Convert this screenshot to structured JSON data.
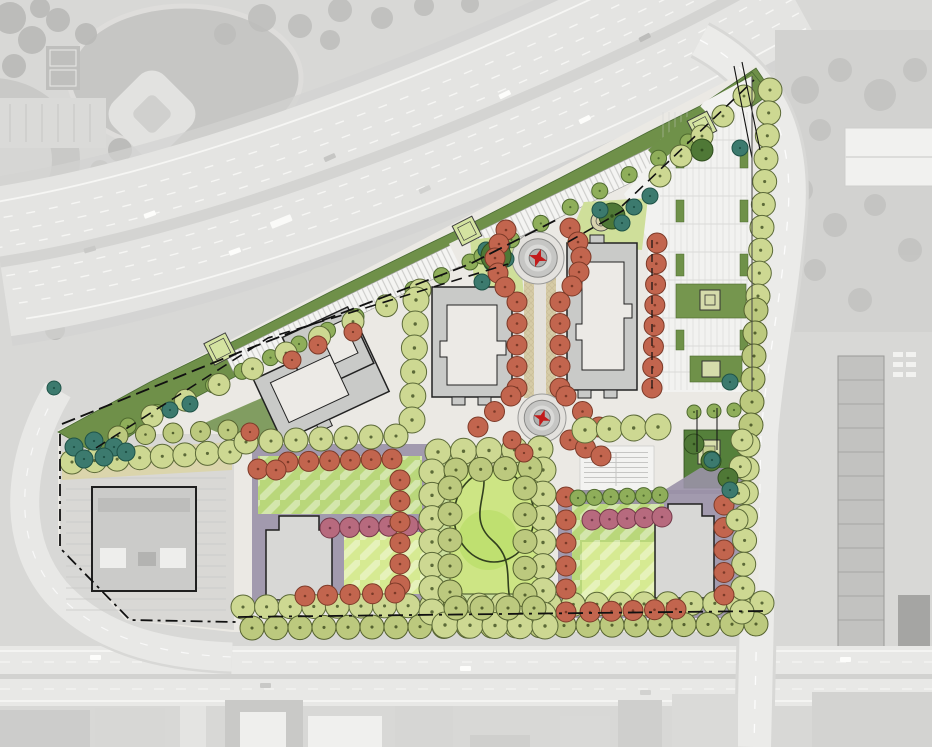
{
  "meta": {
    "view": "aerial-site-plan-rendering",
    "site": "triangular mixed-use development parcel between a freeway and a boulevard"
  },
  "palette": {
    "aerial_base": "#d8d8d6",
    "aerial_field": "#c6c6c4",
    "aerial_road": "#e9e9e7",
    "highway": "#e4e4e2",
    "verge": "#d0d0ce",
    "site_ground": "#ebe9e4",
    "buffer_green": "#6f9049",
    "canopy_dark": "#4f7836",
    "plaza_green": "#d4e3a1",
    "parking_white": "#f2f2f0",
    "stall_line": "#cfcfcd",
    "island_green": "#6f9149",
    "lawn": "#b9d77a",
    "lawn_bright": "#d6ea92",
    "park_lawn": "#cde584",
    "podium_purple": "#9a91a7",
    "building_fill": "#c9cac8",
    "building_stroke": "#222222",
    "footprint_white": "#eceae6",
    "tower_fill": "#d8d8d6",
    "paving_tan": "#d6cba6",
    "boundary": "#111111",
    "star_red": "#c21a1a",
    "roundabout_outer": "#e3e1dd"
  },
  "tree_types": {
    "olive": {
      "fill": "#cdd892",
      "stroke": "#5c6a38"
    },
    "olive2": {
      "fill": "#bcc97e",
      "stroke": "#55622f"
    },
    "green": {
      "fill": "#8fae5a",
      "stroke": "#4e6a2e"
    },
    "dark": {
      "fill": "#4f7836",
      "stroke": "#2f4d1d"
    },
    "teal": {
      "fill": "#3c7a6e",
      "stroke": "#1f5348"
    },
    "red": {
      "fill": "#c2654e",
      "stroke": "#7c3a28"
    },
    "pink": {
      "fill": "#b76a7e",
      "stroke": "#74394a"
    }
  },
  "trees": {
    "rows": [
      [
        "olive",
        243,
        607,
        762,
        603,
        23,
        12
      ],
      [
        "olive2",
        252,
        628,
        756,
        624,
        22,
        12
      ],
      [
        "olive",
        770,
        90,
        758,
        296,
        10,
        12
      ],
      [
        "olive2",
        756,
        310,
        751,
        425,
        6,
        12
      ],
      [
        "olive",
        748,
        445,
        742,
        612,
        8,
        12
      ],
      [
        "green",
        128,
        426,
        470,
        262,
        13,
        8
      ],
      [
        "green",
        482,
        256,
        688,
        142,
        8,
        8
      ],
      [
        "olive",
        152,
        416,
        420,
        290,
        9,
        11
      ],
      [
        "olive",
        72,
        462,
        230,
        452,
        8,
        12
      ],
      [
        "olive2",
        118,
        436,
        228,
        430,
        5,
        10
      ],
      [
        "olive",
        416,
        300,
        412,
        420,
        6,
        13
      ],
      [
        "olive",
        246,
        442,
        396,
        436,
        7,
        12
      ],
      [
        "red",
        517,
        302,
        517,
        388,
        5,
        10
      ],
      [
        "red",
        560,
        302,
        560,
        388,
        5,
        10
      ],
      [
        "red",
        511,
        396,
        478,
        427,
        3,
        10
      ],
      [
        "red",
        566,
        396,
        599,
        427,
        3,
        10
      ],
      [
        "red",
        570,
        440,
        601,
        456,
        3,
        10
      ],
      [
        "red",
        288,
        462,
        392,
        459,
        6,
        10
      ],
      [
        "red",
        258,
        469,
        276,
        470,
        2,
        10
      ],
      [
        "pink",
        330,
        528,
        428,
        525,
        6,
        10
      ],
      [
        "red",
        400,
        480,
        400,
        585,
        6,
        10
      ],
      [
        "red",
        305,
        596,
        395,
        593,
        5,
        10
      ],
      [
        "red",
        566,
        497,
        566,
        612,
        6,
        10
      ],
      [
        "pink",
        592,
        520,
        662,
        517,
        5,
        10
      ],
      [
        "red",
        590,
        612,
        676,
        609,
        5,
        10
      ],
      [
        "red",
        724,
        505,
        724,
        595,
        5,
        10
      ],
      [
        "red",
        657,
        243,
        652,
        388,
        8,
        10
      ],
      [
        "olive",
        438,
        452,
        540,
        449,
        5,
        13
      ],
      [
        "olive",
        543,
        470,
        543,
        615,
        7,
        13
      ],
      [
        "olive",
        432,
        472,
        432,
        612,
        7,
        13
      ],
      [
        "olive",
        445,
        625,
        545,
        626,
        5,
        13
      ],
      [
        "olive2",
        456,
        470,
        530,
        468,
        4,
        12
      ],
      [
        "olive2",
        525,
        488,
        525,
        595,
        5,
        12
      ],
      [
        "olive2",
        450,
        488,
        450,
        592,
        5,
        12
      ],
      [
        "olive2",
        456,
        608,
        534,
        608,
        4,
        12
      ],
      [
        "olive",
        585,
        430,
        658,
        427,
        4,
        13
      ],
      [
        "green",
        578,
        498,
        660,
        495,
        6,
        8
      ],
      [
        "olive",
        742,
        440,
        737,
        520,
        4,
        11
      ],
      [
        "olive",
        660,
        176,
        744,
        96,
        5,
        11
      ],
      [
        "dark",
        694,
        444,
        728,
        478,
        3,
        10
      ],
      [
        "green",
        694,
        412,
        734,
        410,
        3,
        7
      ]
    ],
    "singles": [
      [
        "teal",
        74,
        447,
        9
      ],
      [
        "teal",
        94,
        441,
        9
      ],
      [
        "teal",
        114,
        447,
        9
      ],
      [
        "teal",
        84,
        459,
        9
      ],
      [
        "teal",
        104,
        457,
        9
      ],
      [
        "teal",
        126,
        452,
        9
      ],
      [
        "teal",
        54,
        388,
        7
      ],
      [
        "teal",
        170,
        410,
        8
      ],
      [
        "teal",
        190,
        404,
        8
      ],
      [
        "teal",
        486,
        250,
        8
      ],
      [
        "teal",
        502,
        246,
        8
      ],
      [
        "teal",
        492,
        263,
        8
      ],
      [
        "teal",
        506,
        259,
        8
      ],
      [
        "dark",
        496,
        256,
        15
      ],
      [
        "teal",
        482,
        282,
        8
      ],
      [
        "dark",
        612,
        216,
        13
      ],
      [
        "teal",
        600,
        210,
        8
      ],
      [
        "teal",
        622,
        223,
        8
      ],
      [
        "teal",
        634,
        207,
        8
      ],
      [
        "teal",
        650,
        196,
        8
      ],
      [
        "teal",
        740,
        148,
        8
      ],
      [
        "dark",
        702,
        150,
        11
      ],
      [
        "teal",
        712,
        460,
        8
      ],
      [
        "teal",
        730,
        490,
        8
      ],
      [
        "teal",
        730,
        382,
        8
      ],
      [
        "red",
        250,
        432,
        9
      ],
      [
        "red",
        512,
        440,
        9
      ],
      [
        "red",
        524,
        453,
        9
      ],
      [
        "red",
        292,
        360,
        9
      ],
      [
        "red",
        318,
        345,
        9
      ],
      [
        "red",
        353,
        332,
        9
      ],
      [
        "red",
        506,
        230,
        10
      ],
      [
        "red",
        499,
        244,
        10
      ],
      [
        "red",
        495,
        258,
        10
      ],
      [
        "red",
        498,
        273,
        10
      ],
      [
        "red",
        505,
        287,
        10
      ],
      [
        "red",
        570,
        228,
        10
      ],
      [
        "red",
        578,
        242,
        10
      ],
      [
        "red",
        581,
        257,
        10
      ],
      [
        "red",
        579,
        272,
        10
      ],
      [
        "red",
        572,
        286,
        10
      ]
    ]
  },
  "features": {
    "roundabouts": [
      {
        "cx": 538,
        "cy": 258,
        "r": 26
      },
      {
        "cx": 542,
        "cy": 418,
        "r": 24
      }
    ],
    "plazas": [
      {
        "x": 220,
        "y": 349,
        "s": 24,
        "a": -27
      },
      {
        "x": 467,
        "y": 231,
        "s": 22,
        "a": -27
      },
      {
        "x": 702,
        "y": 126,
        "s": 22,
        "a": -27
      }
    ],
    "planter": {
      "cx": 601,
      "cy": 221,
      "r": 10
    }
  }
}
